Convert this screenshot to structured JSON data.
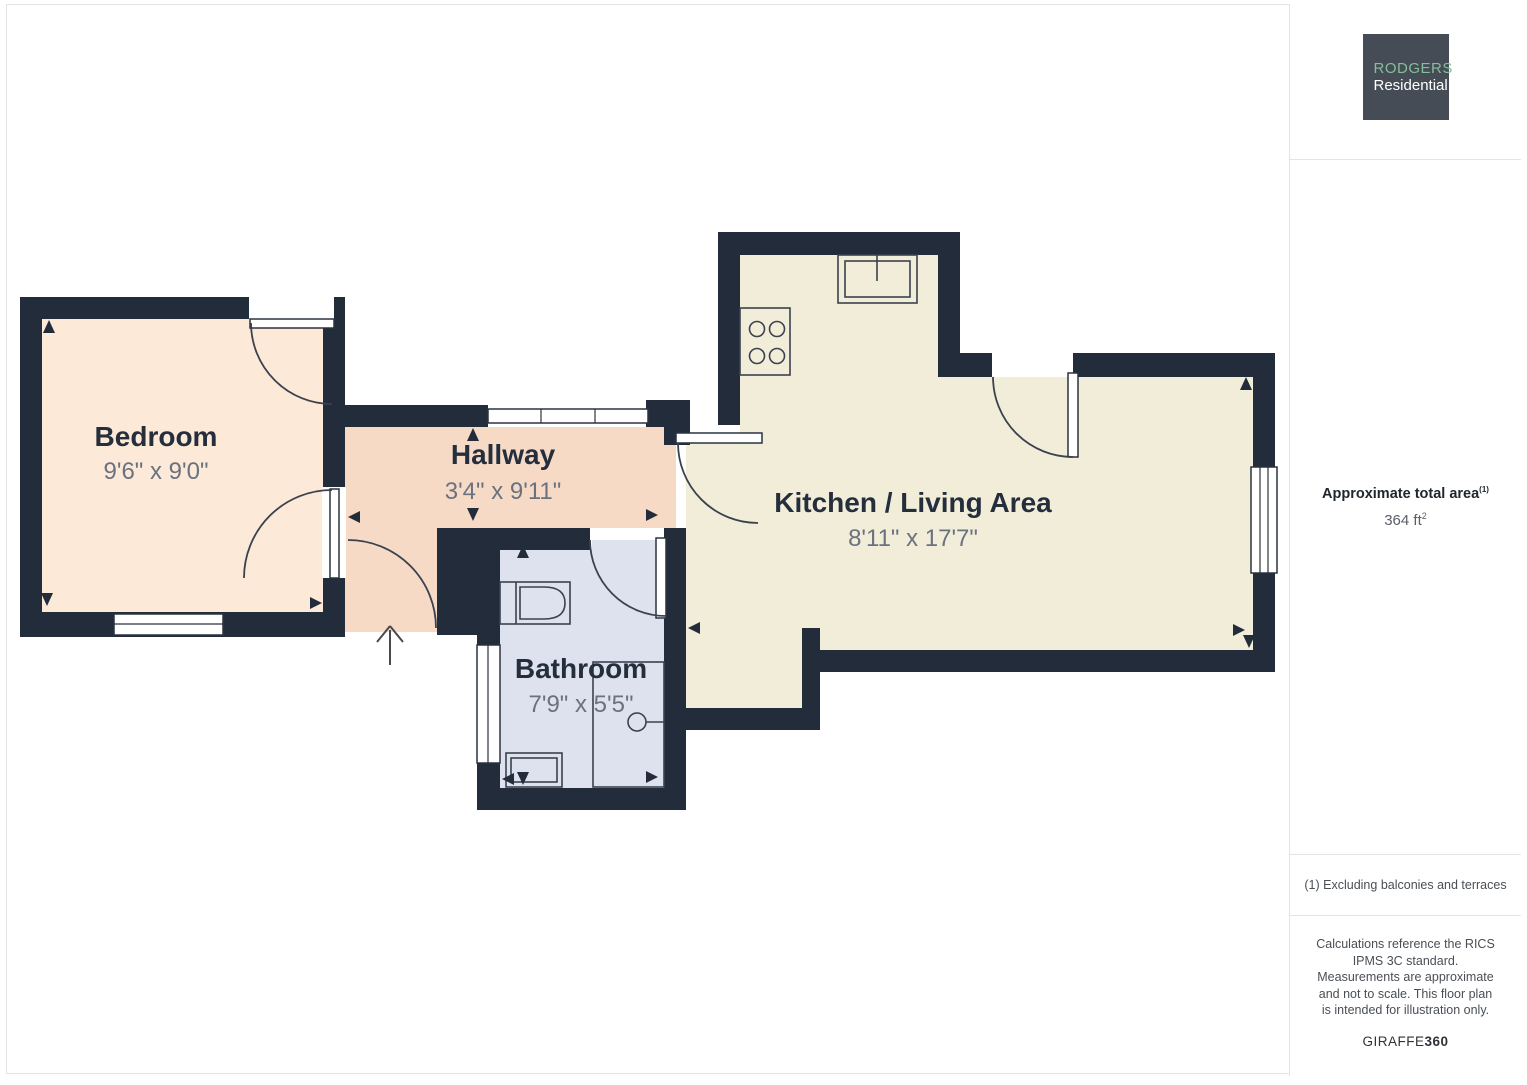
{
  "floor_plan": {
    "rooms": [
      {
        "id": "bedroom",
        "name": "Bedroom",
        "dimensions": "9'6\" x 9'0\""
      },
      {
        "id": "hallway",
        "name": "Hallway",
        "dimensions": "3'4\" x 9'11\""
      },
      {
        "id": "bathroom",
        "name": "Bathroom",
        "dimensions": "7'9\" x 5'5\""
      },
      {
        "id": "kitchen_living",
        "name": "Kitchen / Living Area",
        "dimensions": "8'11\" x 17'7\""
      }
    ],
    "colors": {
      "wall": "#232c3a",
      "bedroom_fill": "#fce9d8",
      "hallway_fill": "#f6dac6",
      "bathroom_fill": "#dee2ee",
      "kitchen_fill": "#f2edd9",
      "label_text": "#252e3c",
      "dimension_text": "#6a7280"
    }
  },
  "sidebar": {
    "logo": {
      "line1": "RODGERS",
      "line2": "Residential",
      "background": "#454c56",
      "accent": "#85be9c"
    },
    "area": {
      "label": "Approximate total area",
      "superscript": "(1)",
      "value": "364 ft",
      "value_sup": "2"
    },
    "footnote": "(1) Excluding balconies and terraces",
    "disclaimer": "Calculations reference the RICS IPMS 3C standard. Measurements are approximate and not to scale. This floor plan is intended for illustration only.",
    "brand_normal": "GIRAFFE",
    "brand_bold": "360"
  }
}
